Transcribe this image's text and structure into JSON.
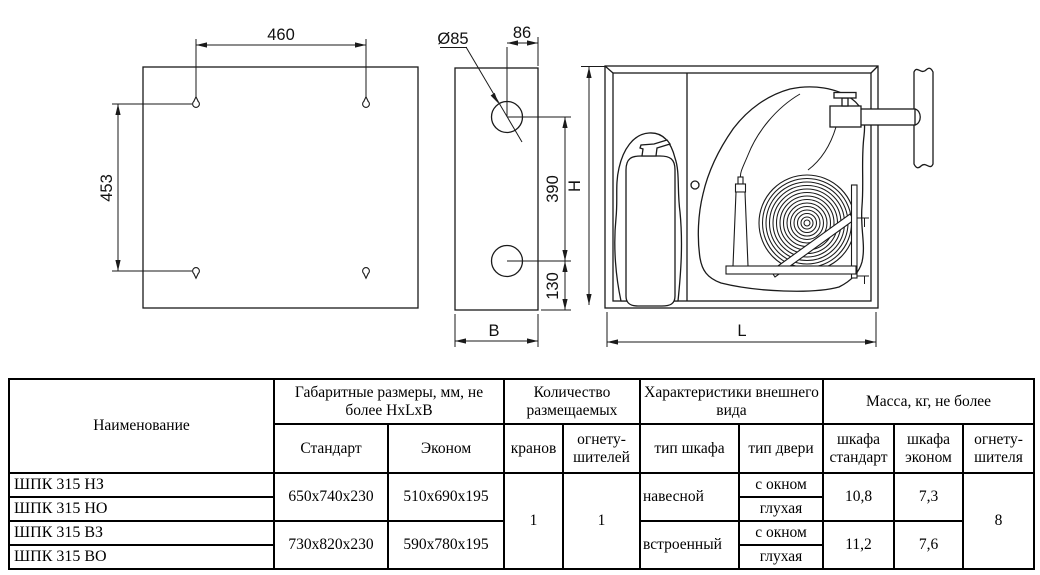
{
  "drawings": {
    "back_view": {
      "width_dim": "460",
      "height_dim": "453"
    },
    "side_view": {
      "hole_diameter": "Ø85",
      "hole_offset": "86",
      "hole_spacing": "390",
      "bottom_offset": "130",
      "depth_label": "B"
    },
    "front_view": {
      "height_label": "H",
      "length_label": "L"
    }
  },
  "table": {
    "header": {
      "name": "Наименование",
      "dimensions_group": "Габаритные размеры, мм, не более HxLxB",
      "standard": "Стандарт",
      "econom": "Эконом",
      "quantity_group": "Количество размещаемых",
      "taps": "кранов",
      "extinguishers": "огнету-шителей",
      "appearance_group": "Характеристики внешнего вида",
      "cabinet_type": "тип шкафа",
      "door_type": "тип двери",
      "mass_group": "Масса, кг, не более",
      "mass_cabinet_standard": "шкафа стандарт",
      "mass_cabinet_econom": "шкафа эконом",
      "mass_extinguisher": "огнету-шителя"
    },
    "body": {
      "row1_name": "ШПК 315 НЗ",
      "row2_name": "ШПК 315 НО",
      "row3_name": "ШПК 315 ВЗ",
      "row4_name": "ШПК 315 ВО",
      "dims_standard_12": "650x740x230",
      "dims_econom_12": "510x690x195",
      "dims_standard_34": "730x820x230",
      "dims_econom_34": "590x780x195",
      "taps_count": "1",
      "extinguishers_count": "1",
      "cabinet_type_12": "навесной",
      "cabinet_type_34": "встроенный",
      "door_1": "с окном",
      "door_2": "глухая",
      "door_3": "с окном",
      "door_4": "глухая",
      "mass_standard_12": "10,8",
      "mass_econom_12": "7,3",
      "mass_standard_34": "11,2",
      "mass_econom_34": "7,6",
      "mass_extinguisher_all": "8"
    }
  },
  "colors": {
    "line": "#1a1a1a",
    "background": "#ffffff"
  }
}
